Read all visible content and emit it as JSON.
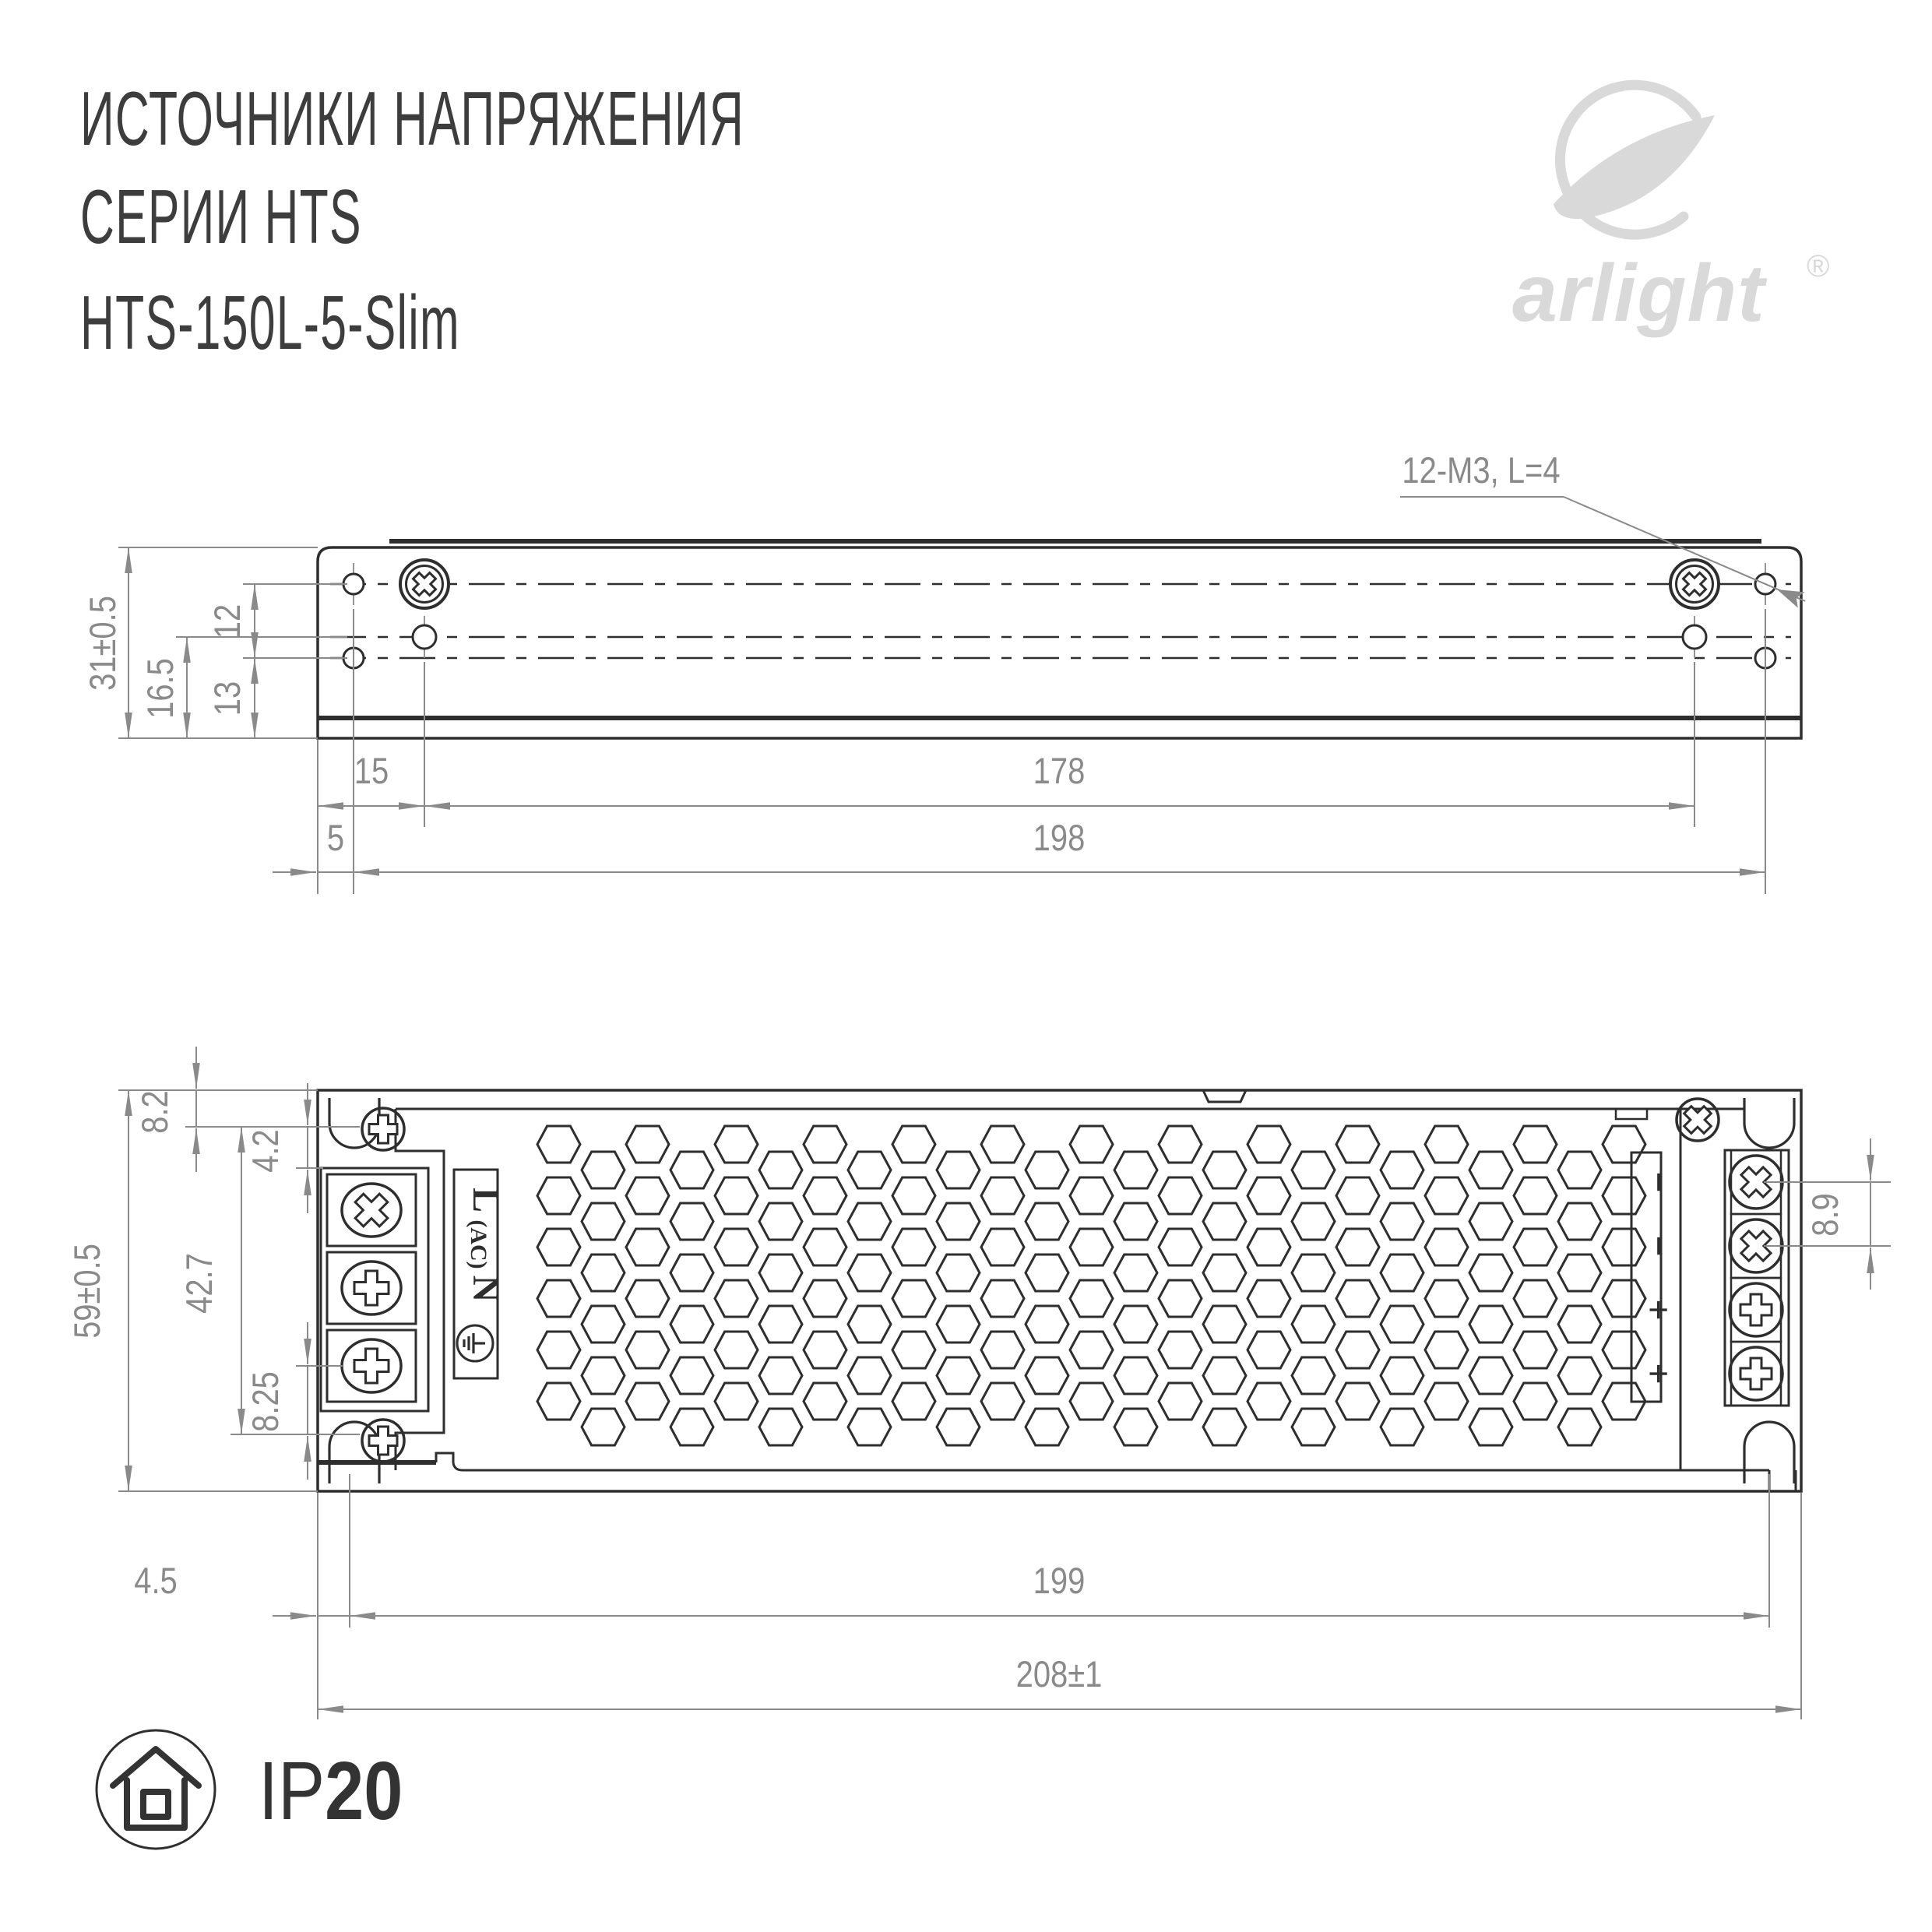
{
  "title": {
    "line1": "ИСТОЧНИКИ НАПРЯЖЕНИЯ",
    "line2": "СЕРИИ HTS",
    "line3": "HTS-150L-5-Slim"
  },
  "brand": {
    "name": "arlight",
    "registered": "®"
  },
  "side_view": {
    "note": "12-M3, L=4",
    "dims": {
      "height_overall": "31±0.5",
      "hole_rows": "12",
      "mid_to_base": "16.5",
      "hole_to_base": "13",
      "edge_to_screw": "15",
      "screw_spacing": "178",
      "edge_to_hole": "5",
      "hole_spacing": "198"
    }
  },
  "top_view": {
    "dims": {
      "top_to_screw": "8.2",
      "screw_to_block": "4.2",
      "screw_rows": "42.7",
      "height_overall": "59±0.5",
      "terminal_to_screw": "8.25",
      "dc_pitch": "8.9",
      "edge_to_mount": "4.5",
      "mount_spacing": "199",
      "length_overall": "208±1"
    },
    "ac_labels": {
      "line": "L",
      "ac": "(AC)",
      "neutral": "N"
    },
    "dc_labels": [
      "−",
      "−",
      "+",
      "+"
    ]
  },
  "ip_badge": {
    "prefix": "IP",
    "value": "20"
  },
  "colors": {
    "ink": "#2e2e2e",
    "dim": "#8a8a8a",
    "logo": "#d9d9d9"
  }
}
